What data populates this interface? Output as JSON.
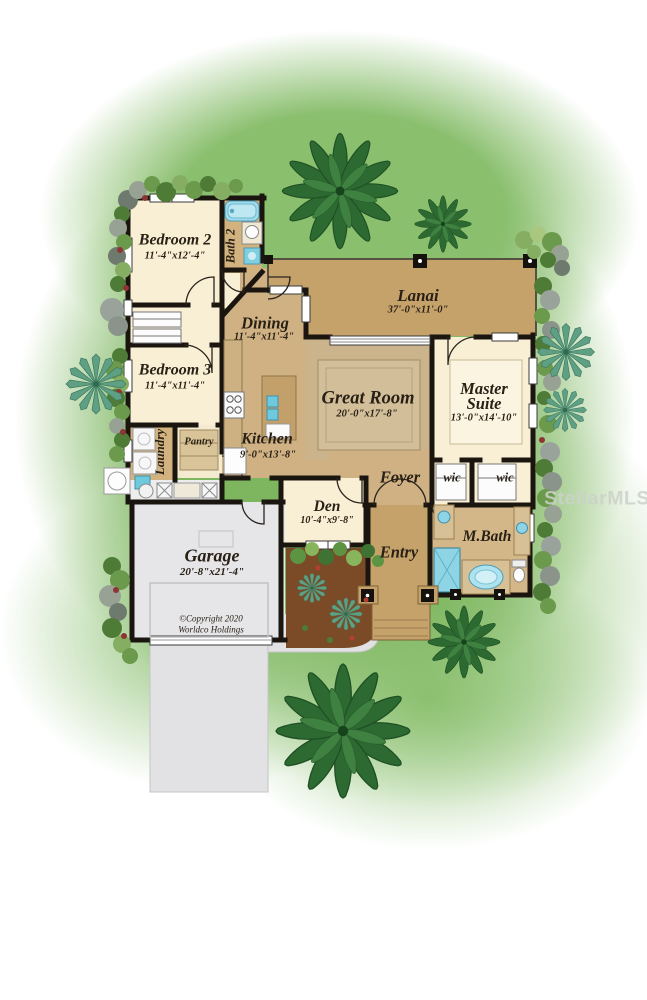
{
  "plan": {
    "watermark": "StellarMLS",
    "copyright": {
      "line1": "©Copyright 2020",
      "line2": "Worldco Holdings"
    },
    "rooms": {
      "bedroom2": {
        "name": "Bedroom 2",
        "dims": "11'-4\"x12'-4\""
      },
      "bath2": {
        "name": "Bath 2"
      },
      "lanai": {
        "name": "Lanai",
        "dims": "37'-0\"x11'-0\""
      },
      "dining": {
        "name": "Dining",
        "dims": "11'-4\"x11'-4\""
      },
      "bedroom3": {
        "name": "Bedroom 3",
        "dims": "11'-4\"x11'-4\""
      },
      "great_room": {
        "name": "Great Room",
        "dims": "20'-0\"x17'-8\""
      },
      "master_suite": {
        "name": "Master Suite",
        "dims": "13'-0\"x14'-10\""
      },
      "kitchen": {
        "name": "Kitchen",
        "dims": "9'-0\"x13'-8\""
      },
      "pantry": {
        "name": "Pantry"
      },
      "laundry": {
        "name": "Laundry"
      },
      "foyer": {
        "name": "Foyer"
      },
      "wic_left": {
        "name": "wic"
      },
      "wic_right": {
        "name": "wic"
      },
      "den": {
        "name": "Den",
        "dims": "10'-4\"x9'-8\""
      },
      "entry": {
        "name": "Entry"
      },
      "master_bath": {
        "name": "M.Bath"
      },
      "garage": {
        "name": "Garage",
        "dims": "20'-8\"x21'-4\""
      }
    },
    "colors": {
      "grass": "#7db65f",
      "floor_tan": "#cfb183",
      "lanai_tan": "#c6a26b",
      "room_cream": "#f8efd5",
      "wall": "#1b1510",
      "water_blue": "#8fd4e4",
      "garage_gray": "#e6e6e8",
      "mulch_brown": "#7a4b26"
    }
  }
}
